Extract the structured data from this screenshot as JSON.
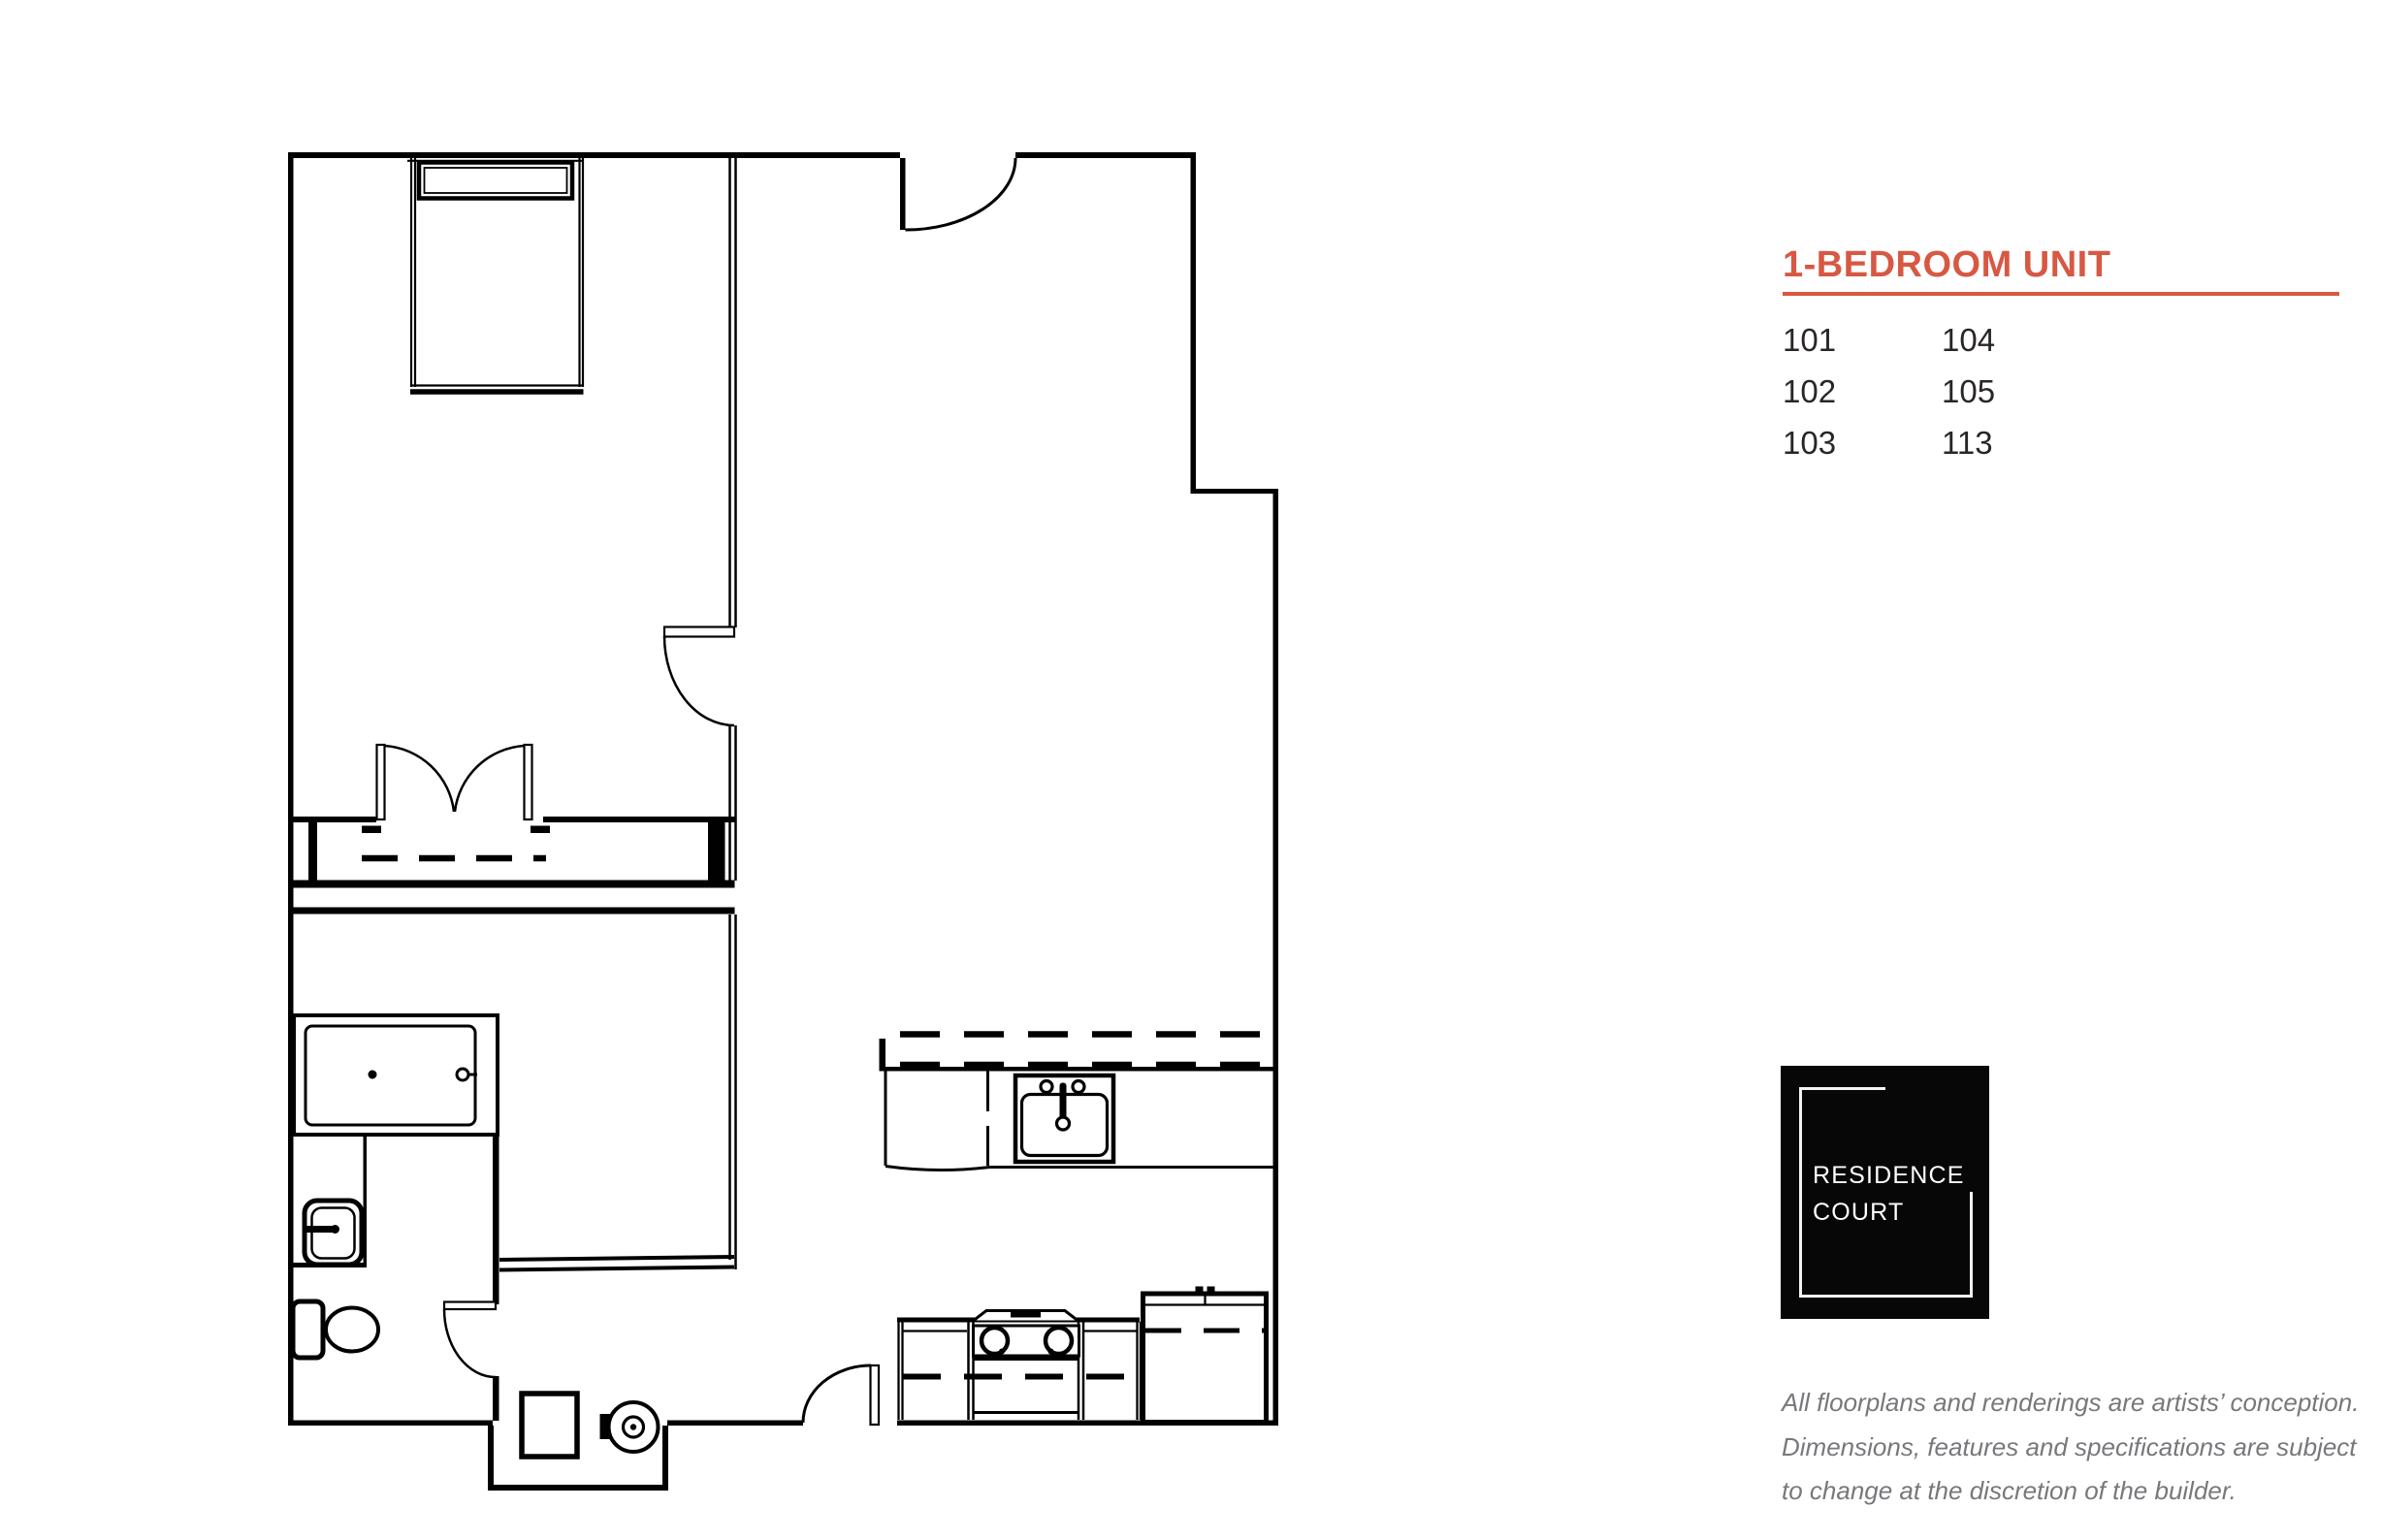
{
  "panel": {
    "title": "1-BEDROOM UNIT",
    "title_color": "#d75843",
    "units": {
      "col1": [
        "101",
        "102",
        "103"
      ],
      "col2": [
        "104",
        "105",
        "113"
      ]
    },
    "logo": {
      "line1": "RESIDENCE",
      "line2": "COURT",
      "bg": "#070707",
      "text_color": "#ffffff"
    },
    "disclaimer": {
      "line1": "All floorplans and renderings are artists’ conception.",
      "line2": "Dimensions, features and specifications are subject",
      "line3": "to change at the discretion of the builder.",
      "color": "#77787b"
    }
  },
  "floorplan": {
    "label": "1-bedroom unit floor plan",
    "line_color": "#010101",
    "rooms": [
      "bedroom",
      "closet",
      "bathroom",
      "dressing-area",
      "entry-hall",
      "living-room",
      "kitchen"
    ],
    "fixtures": [
      "bed",
      "closet-double-doors",
      "closet-hanging-rod",
      "bathtub",
      "vanity-sink",
      "toilet",
      "washer",
      "water-heater",
      "entry-door",
      "bathroom-door",
      "bedroom-door",
      "living-room-door",
      "kitchen-sink",
      "kitchen-counter",
      "range",
      "refrigerator"
    ]
  }
}
